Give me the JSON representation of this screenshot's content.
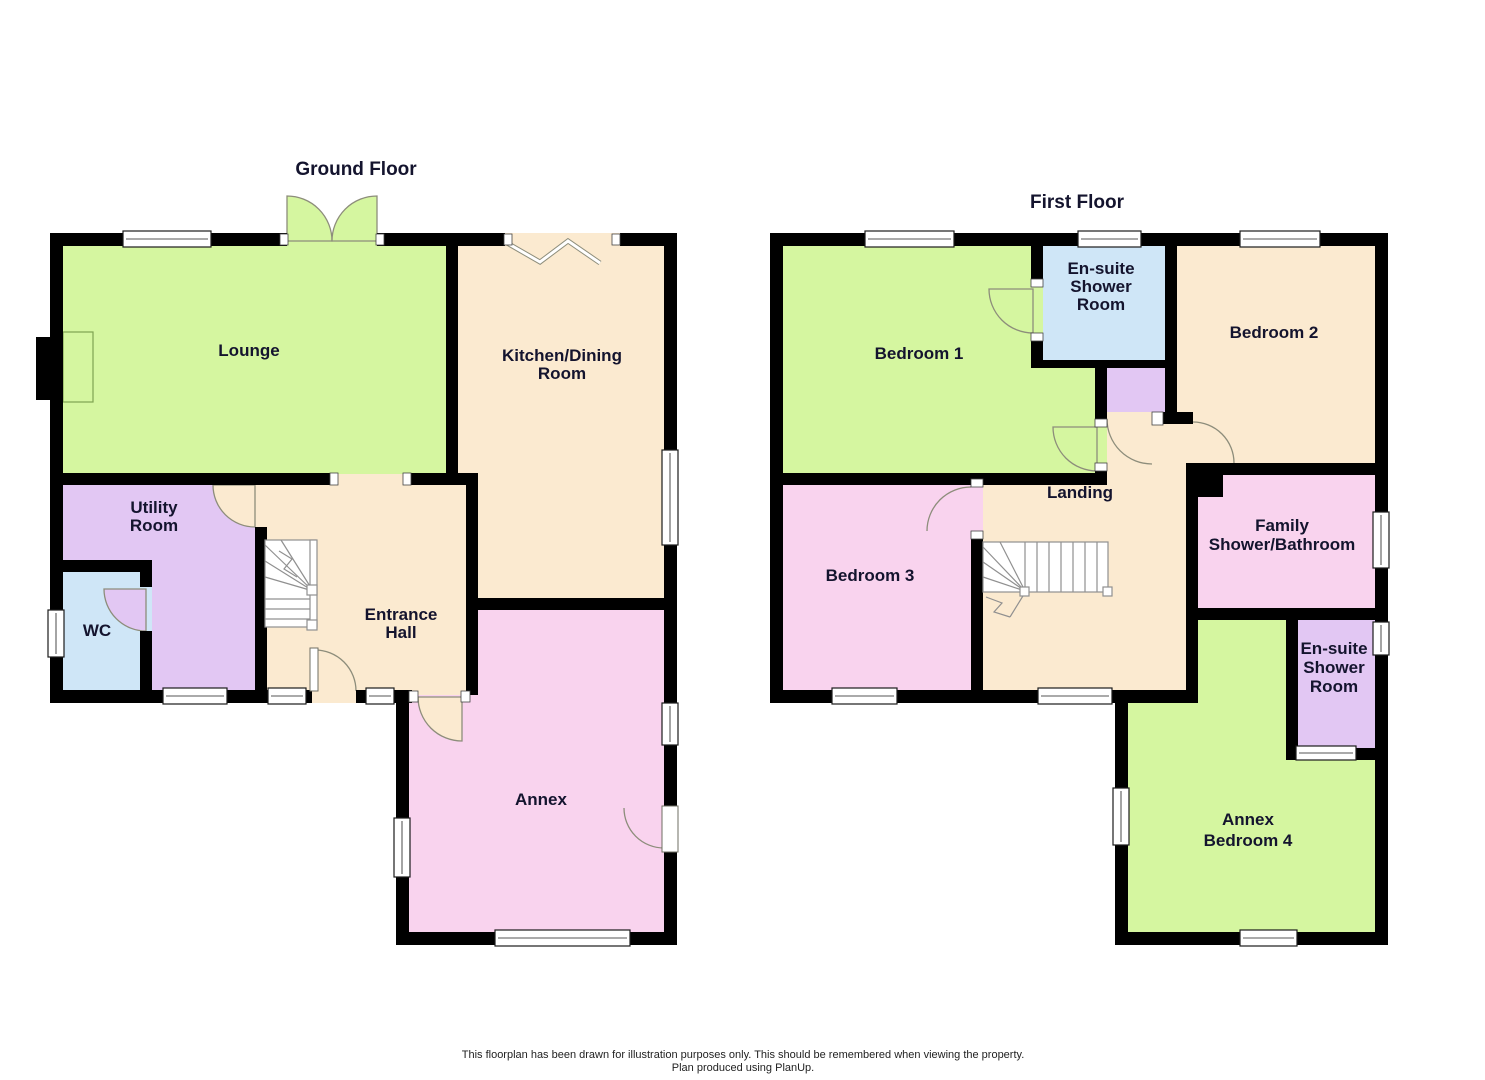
{
  "colors": {
    "wall": "#000000",
    "green": "#d5f6a0",
    "cream": "#fbead0",
    "purple": "#e2c7f3",
    "blue": "#cfe6f7",
    "pink": "#f9d3ee",
    "label": "#14142e"
  },
  "ground_floor": {
    "title": "Ground Floor",
    "rooms": {
      "lounge": {
        "label": "Lounge"
      },
      "kitchen": {
        "lines": [
          "Kitchen/Dining",
          "Room"
        ]
      },
      "utility": {
        "lines": [
          "Utility",
          "Room"
        ]
      },
      "wc": {
        "label": "WC"
      },
      "hall": {
        "lines": [
          "Entrance",
          "Hall"
        ]
      },
      "annex": {
        "label": "Annex"
      }
    }
  },
  "first_floor": {
    "title": "First Floor",
    "rooms": {
      "bedroom1": {
        "label": "Bedroom 1"
      },
      "ensuite1": {
        "lines": [
          "En-suite",
          "Shower",
          "Room"
        ]
      },
      "bedroom2": {
        "label": "Bedroom 2"
      },
      "landing": {
        "label": "Landing"
      },
      "bedroom3": {
        "label": "Bedroom 3"
      },
      "family_bathroom": {
        "lines": [
          "Family",
          "Shower/Bathroom"
        ]
      },
      "ensuite2": {
        "lines": [
          "En-suite",
          "Shower",
          "Room"
        ]
      },
      "annex_bedroom4": {
        "lines": [
          "Annex",
          "Bedroom 4"
        ]
      }
    }
  },
  "footer": {
    "line1": "This floorplan has been drawn for illustration purposes only. This should be remembered when viewing the property.",
    "line2": "Plan produced using PlanUp."
  }
}
